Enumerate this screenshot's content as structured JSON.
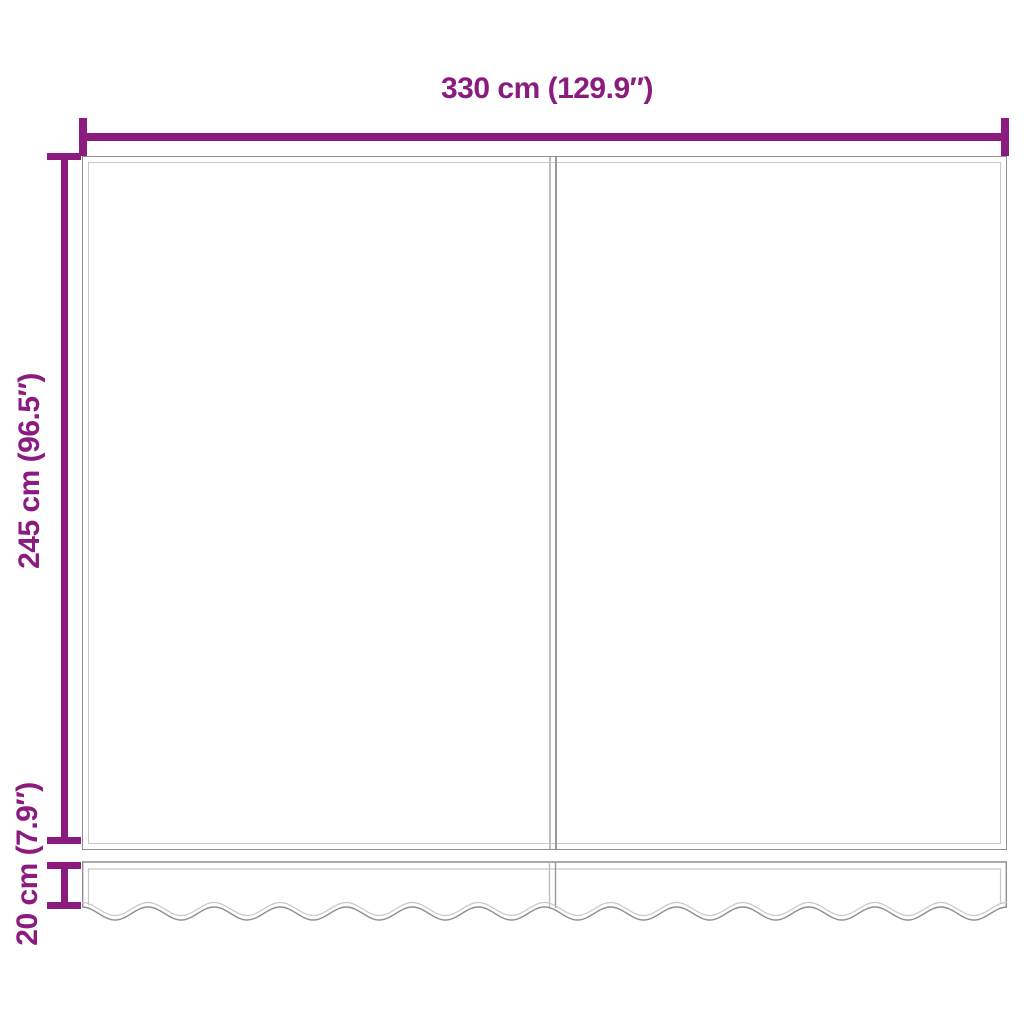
{
  "diagram": {
    "type": "product-dimension-diagram",
    "subject": "awning-fabric-with-valance",
    "dimensions": {
      "width": {
        "cm": 330,
        "inches": 129.9,
        "label": "330 cm (129.9″)"
      },
      "height": {
        "cm": 245,
        "inches": 96.5,
        "label": "245 cm (96.5″)"
      },
      "valance": {
        "cm": 20,
        "inches": 7.9,
        "label": "20 cm (7.9″)"
      }
    }
  },
  "colors": {
    "accent": "#8C1B80",
    "outline": "#8F8F93",
    "hem": "#C8C8CC",
    "seam_light": "#BDBDC1",
    "seam_dark": "#9A9A9E",
    "background": "#FFFFFF"
  }
}
